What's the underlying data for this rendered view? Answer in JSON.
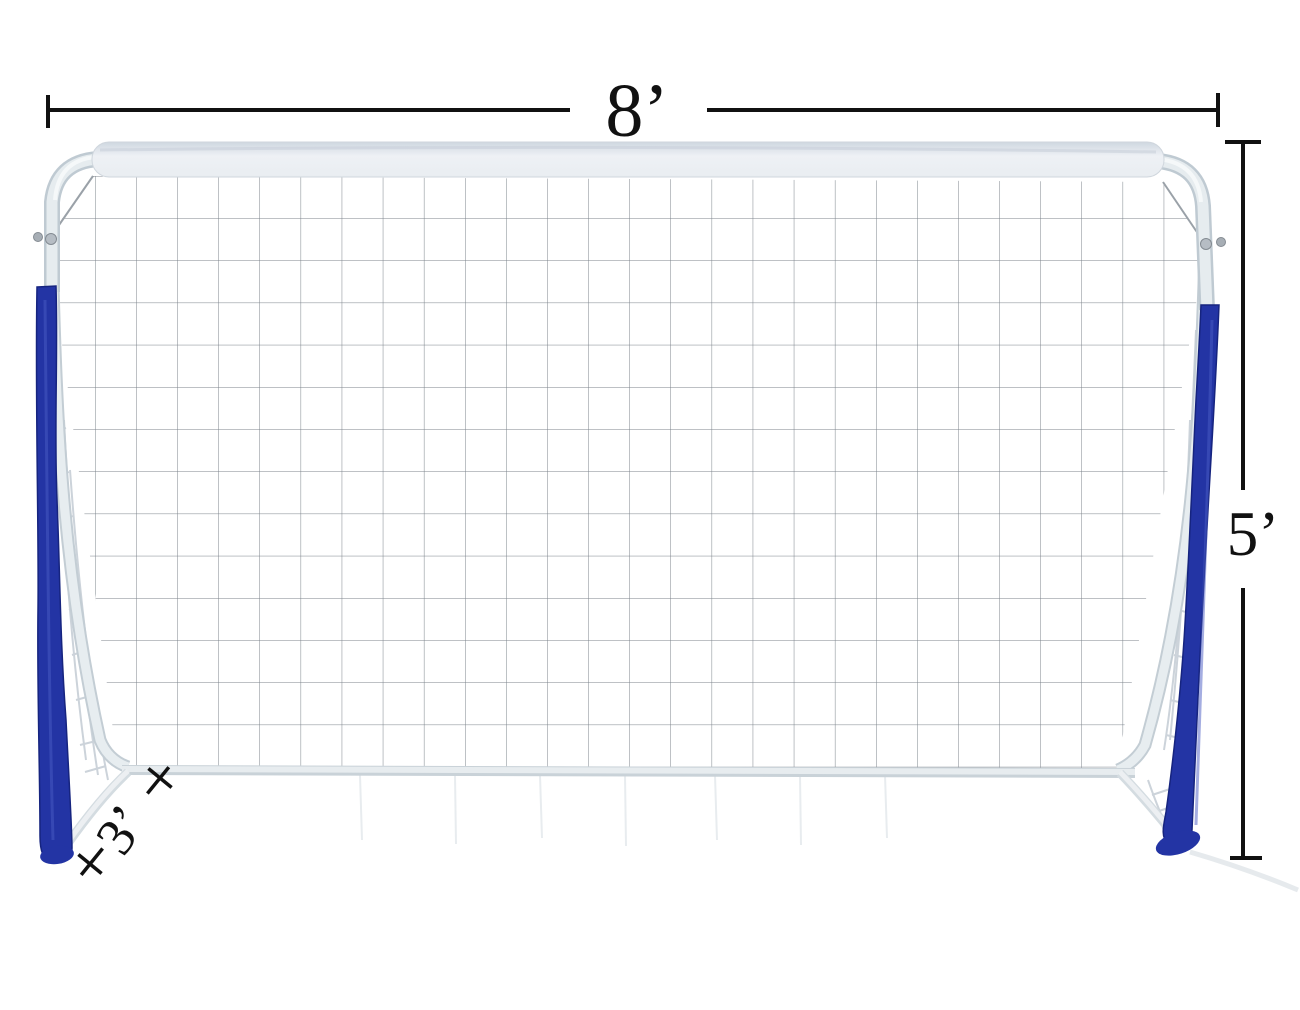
{
  "annotations": {
    "width": {
      "label": "8’",
      "value_feet": 8,
      "orientation": "horizontal-top"
    },
    "height": {
      "label": "5’",
      "value_feet": 5,
      "orientation": "vertical-right"
    },
    "depth": {
      "label": "3’",
      "value_feet": 3,
      "orientation": "diagonal-bottom-left"
    }
  },
  "colors": {
    "pad_blue": "#2334a4",
    "pad_blue_edge": "#16247f",
    "frame_white": "#e4eaee",
    "frame_shadow": "#c3cdd4",
    "net_line": "#7b828a",
    "side_net_line": "#ccd3da",
    "dimension_black": "#111111",
    "background": "#ffffff"
  }
}
